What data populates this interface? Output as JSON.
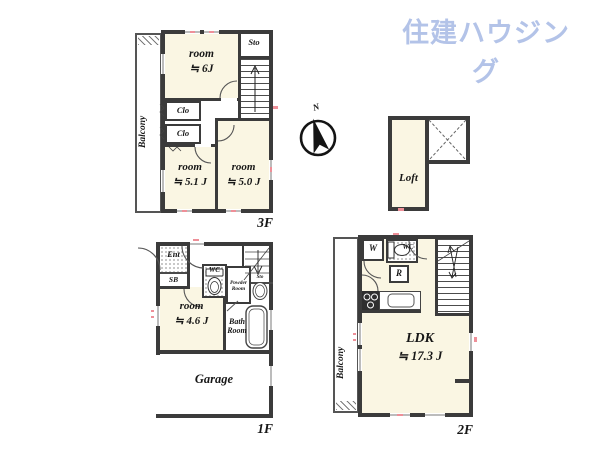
{
  "brand": {
    "logo_text": "住建ハウジング"
  },
  "compass": {
    "north_label": "N"
  },
  "colors": {
    "wall": "#3b3b3b",
    "floor_cream": "#faf6e3",
    "logo_blue": "#b3c3e8",
    "accent_pink": "#ee8f98"
  },
  "floor_3f": {
    "label": "3F",
    "balcony_label": "Balcony",
    "room_6": {
      "name": "room",
      "area": "≒ 6J"
    },
    "storage_label": "Sto",
    "closet_1_label": "Clo",
    "closet_2_label": "Clo",
    "room_51": {
      "name": "room",
      "area": "≒ 5.1 J"
    },
    "room_50": {
      "name": "room",
      "area": "≒ 5.0 J"
    }
  },
  "loft": {
    "label": "Loft"
  },
  "floor_1f": {
    "label": "1F",
    "entrance_label": "Ent",
    "shoebox_label": "SB",
    "wc_label": "WC",
    "storage_label": "Sto",
    "powder_room_label": "Powder Room",
    "bath_room_label": "Bath Room",
    "room_46": {
      "name": "room",
      "area": "≒ 4.6 J"
    },
    "garage_label": "Garage"
  },
  "floor_2f": {
    "label": "2F",
    "balcony_label": "Balcony",
    "washer_label": "W",
    "wc_label": "WC",
    "fridge_label": "R",
    "ldk": {
      "name": "LDK",
      "area": "≒ 17.3 J"
    }
  }
}
